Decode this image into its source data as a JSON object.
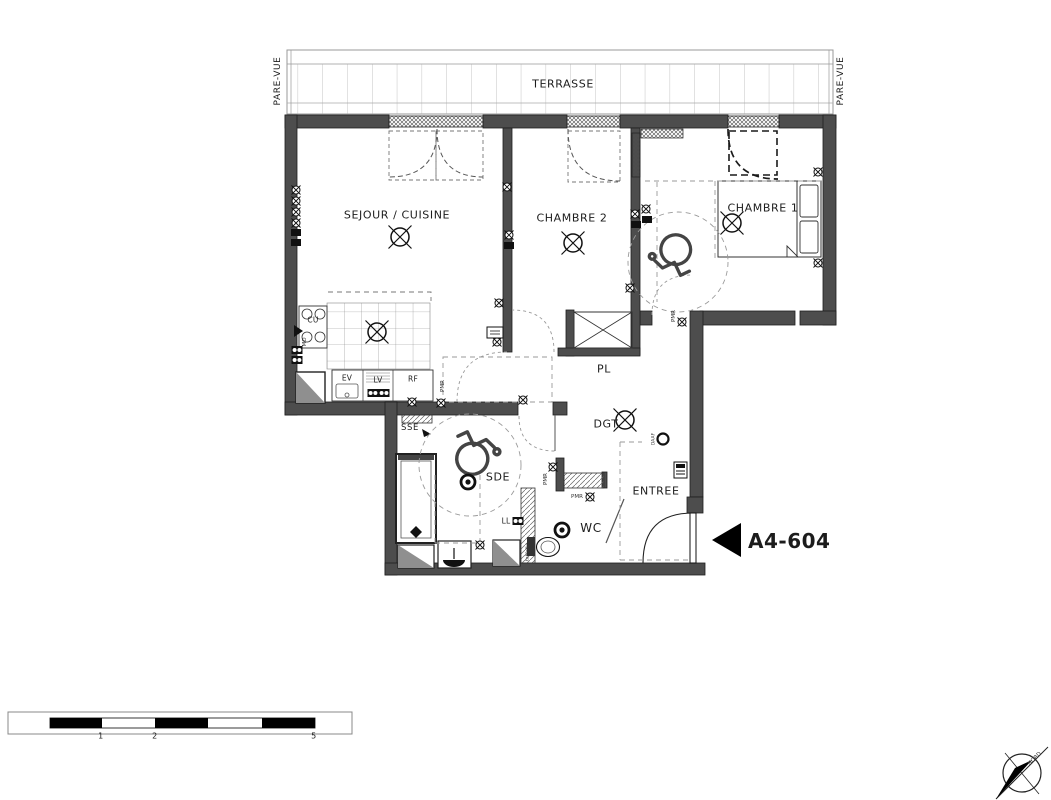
{
  "unit": {
    "code": "A4-604"
  },
  "terrace": {
    "label": "TERRASSE",
    "pare_vue": "PARE-VUE"
  },
  "rooms": {
    "sejour_cuisine": "SEJOUR / CUISINE",
    "chambre2": "CHAMBRE 2",
    "chambre1": "CHAMBRE 1",
    "placard": "PL",
    "degagement": "DGT",
    "salle_eau": "SDE",
    "wc": "WC",
    "entree": "ENTREE"
  },
  "kitchen": {
    "cooktop": "CU",
    "microwave": "MO",
    "sink": "EV",
    "dishwasher": "LV",
    "fridge": "RF"
  },
  "annotations": {
    "towel_dryer": "SSE",
    "washing_machine": "LL",
    "smoke_detector": "DAAF",
    "shelf": "tablette",
    "accessibility": "PMR"
  },
  "compass": {
    "north": "NORD"
  },
  "scale_bar": {
    "ticks": [
      "1",
      "2",
      "5"
    ]
  }
}
